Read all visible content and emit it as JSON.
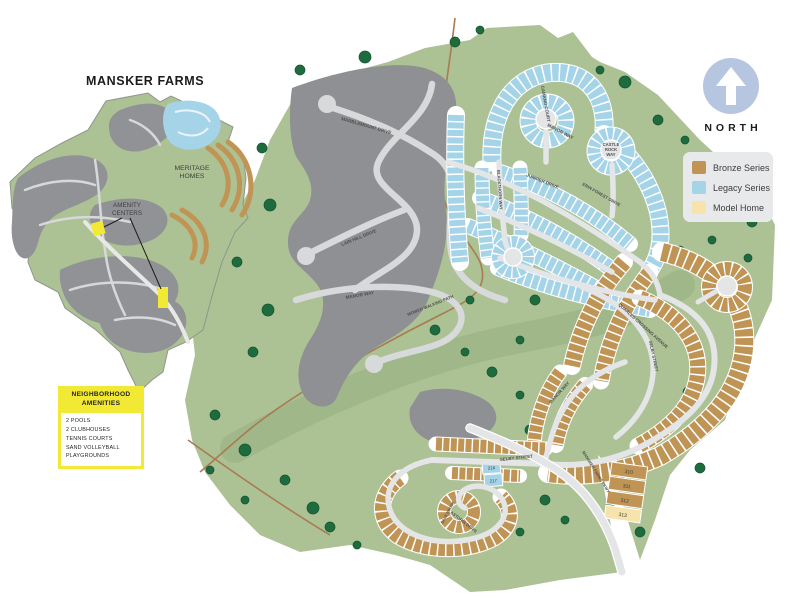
{
  "inset": {
    "title": "MANSKER FARMS",
    "meritage_label_line1": "MERITAGE",
    "meritage_label_line2": "HOMES",
    "amenity_label_line1": "AMENITY",
    "amenity_label_line2": "CENTERS",
    "amenity_marker_color": "#F2E935"
  },
  "amenities_box": {
    "heading_line1": "NEIGHBORHOOD",
    "heading_line2": "AMENITIES",
    "items": [
      "2 POOLS",
      "2 CLUBHOUSES",
      "TENNIS COURTS",
      "SAND VOLLEYBALL",
      "PLAYGROUNDS"
    ]
  },
  "compass": {
    "label": "NORTH"
  },
  "legend": {
    "items": [
      {
        "label": "Bronze Series",
        "color": "#BF9455"
      },
      {
        "label": "Legacy Series",
        "color": "#A5D4E9"
      },
      {
        "label": "Model Home",
        "color": "#F6E4AC"
      }
    ]
  },
  "map": {
    "streets": {
      "marblemount": "MARBLEMOUNT DRIVE",
      "lain_hill": "LAIN HILL DRIVE",
      "manor_gray": "MANOR WAY",
      "camano": "CAMANO COURT",
      "manor_legacy": "MANOR WAY",
      "castle_line1": "CASTLE",
      "castle_line2": "ROCK",
      "castle_line3": "WAY",
      "juniper": "JUNIPER DRIVE",
      "erin_forest": "ERIN FOREST DRIVE",
      "blackthorn": "BLACKTHORN WAY",
      "quarles": "QUARLES CROSSING AVENUE",
      "selby_vertical": "SELBY STREET",
      "selby_horizontal": "SELBY STREET",
      "manor_bronze": "MANOR WAY",
      "mansker_pkwy": "MANSKER FARMS PKWY",
      "astoria": "ASTORIA DRIVE",
      "sage_brook": "SAGE BROOK"
    },
    "walking_path_label": "MOWED WALKING PATH",
    "detached_lots": [
      "310",
      "311",
      "312",
      "313"
    ],
    "legacy_lots_near_selby": [
      "216",
      "217"
    ],
    "lot_numbering_visible": {
      "legacy_area": "1–131",
      "bronze_area": "15–240"
    },
    "colors": {
      "greenspace": "#ACC295",
      "greenway_band": "#9DB687",
      "tree": "#1E6B3E",
      "future_phase_gray": "#8E9093",
      "road": "#E4E5E6",
      "bronze_series": "#BF9455",
      "legacy_series": "#A5D4E9",
      "model_home": "#F6E4AC",
      "walking_path": "#A87B50"
    }
  }
}
